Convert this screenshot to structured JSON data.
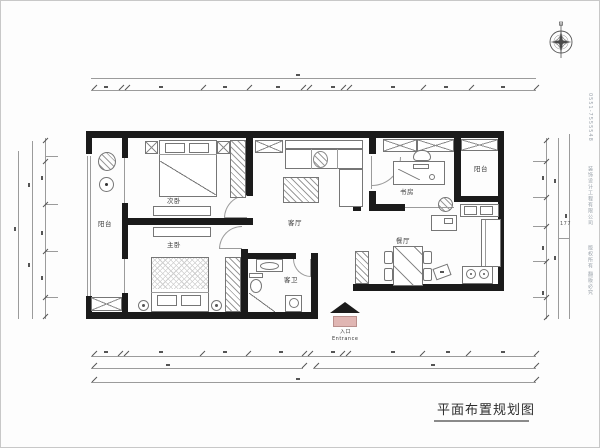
{
  "title": {
    "text": "平面布置规划图"
  },
  "rooms": {
    "balcony_left": "阳台",
    "second_bedroom": "次卧",
    "master_bedroom": "主卧",
    "living_room": "客厅",
    "guest_bath": "客卫",
    "study": "书房",
    "dining": "餐厅",
    "balcony_right": "阳台"
  },
  "entrance": {
    "cn": "入口",
    "en": "Entrance"
  },
  "dimensions": {
    "right_note": "177"
  },
  "watermark": {
    "seg1": "0551-7555548",
    "seg2": "装饰设计工程有限公司",
    "seg3": "版权所有 翻版必究"
  },
  "colors": {
    "wall": "#1b1b1b",
    "line": "#9b9b9b",
    "entrance_fill": "#e0b6b3",
    "text": "#3a3a3a"
  }
}
